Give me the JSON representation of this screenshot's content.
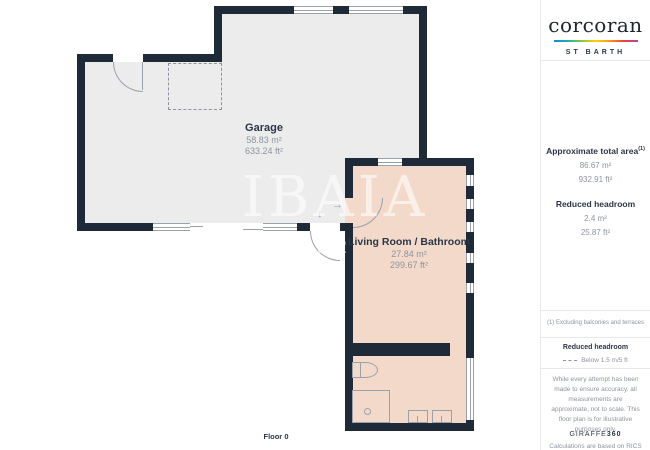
{
  "brand": {
    "logo_text": "corcoran",
    "office": "ST BARTH"
  },
  "panel": {
    "approx_area_label": "Approximate total area",
    "approx_area_sup": "(1)",
    "approx_area_m2": "86.67 m²",
    "approx_area_ft2": "932.91 ft²",
    "reduced_headroom_label": "Reduced headroom",
    "reduced_headroom_m2": "2.4 m²",
    "reduced_headroom_ft2": "25.87 ft²",
    "note": "(1) Excluding balconies and terraces",
    "legend_label": "Reduced headroom",
    "legend_value": "Below 1.5 m/5 ft",
    "disclaimer1": "While every attempt has been made to ensure accuracy, all measurements are approximate, not to scale. This floor plan is for illustrative purposes only.",
    "disclaimer2": "Calculations are based on RICS IPMS 3C standard.",
    "credit_brand": "GIRAFFE",
    "credit_num": "360"
  },
  "plan": {
    "floor_label": "Floor 0",
    "watermark_line1": "IBAIA",
    "watermark_line2": "ER",
    "rooms": [
      {
        "name": "Garage",
        "m2": "58.83 m²",
        "ft2": "633.24 ft²"
      },
      {
        "name": "Living Room / Bathroom",
        "m2": "27.84 m²",
        "ft2": "299.67 ft²"
      }
    ],
    "icons": {
      "entry_arrow": "→",
      "exit_arrow": "↓"
    }
  },
  "colors": {
    "wall": "#1f2a38",
    "garage_floor": "#ececec",
    "living_floor": "#f3d9c9",
    "line": "#9aa1ab",
    "text_dark": "#2b3648",
    "text_gray": "#8d949e",
    "divider": "#e8e8e8",
    "watermark": "rgba(255,255,255,0.6)"
  },
  "spectrum": [
    "#0f8bcc",
    "#1fb0a9",
    "#8dc63f",
    "#ffd200",
    "#f7941e",
    "#ef4136",
    "#b04a98"
  ]
}
